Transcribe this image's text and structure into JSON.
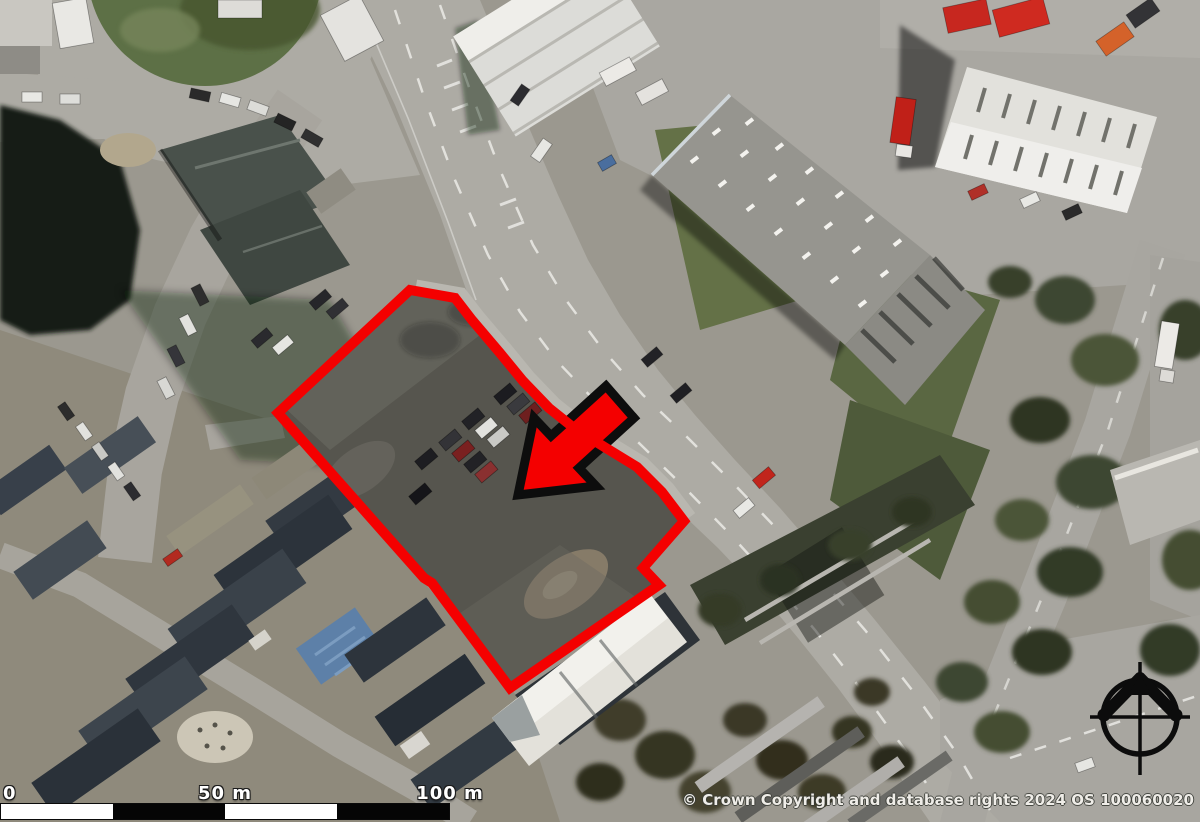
{
  "map": {
    "kind": "aerial-imagery-with-site-annotation",
    "copyright": "© Crown Copyright and database rights 2024 OS 100060020"
  },
  "scale_bar": {
    "label_start": "0",
    "label_mid": "50 m",
    "label_end": "100 m"
  },
  "overlay": {
    "boundary_color": "#f40000",
    "boundary_width": "10",
    "site_boundary_points": "410,290 455,298 472,320 500,353 523,381 549,408 574,428 606,448 637,467 662,492 684,521 643,568 659,585 510,688 432,583 424,578 278,413",
    "arrow_fill": "#f40000",
    "arrow_outline": "#0d0d0d",
    "arrow_points": "606,386 634,418 579,468 596,486 518,495 534,418 551,436"
  },
  "compass": {
    "icon": "north-compass-icon"
  }
}
